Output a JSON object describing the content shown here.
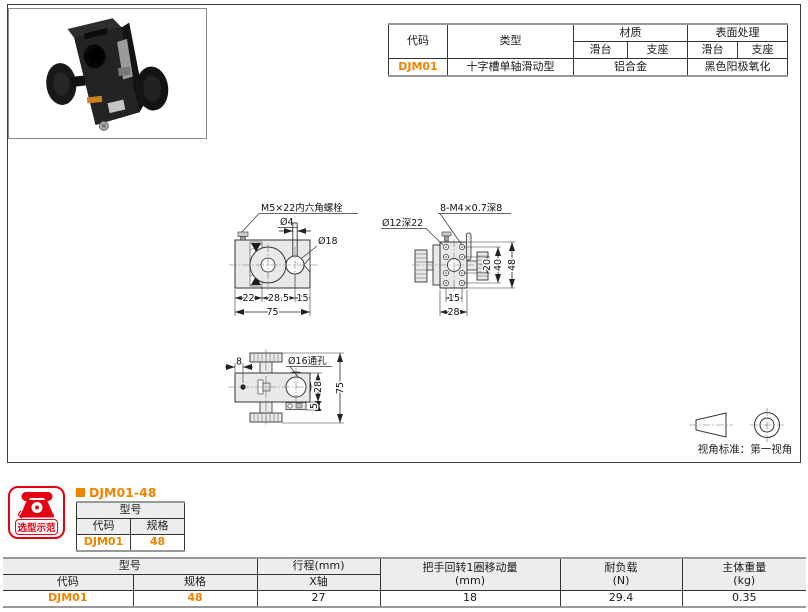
{
  "colors": {
    "accent": "#f08300",
    "badge_red": "#e60012"
  },
  "spec_table": {
    "col_code": "代码",
    "col_type": "类型",
    "col_material": "材质",
    "col_surface": "表面处理",
    "sub_slide": "滑台",
    "sub_base": "支座",
    "sub_slide2": "滑台",
    "sub_base2": "支座",
    "row": {
      "code": "DJM01",
      "type": "十字槽单轴滑动型",
      "material": "铝合金",
      "surface": "黑色阳极氧化"
    }
  },
  "drawing_front": {
    "bolt_label": "M5×22内六角螺栓",
    "dia4": "Ø4",
    "dia18": "Ø18",
    "dim_22": "22",
    "dim_28_5": "28.5",
    "dim_15": "15",
    "dim_75": "75"
  },
  "drawing_side": {
    "holes_label": "8-M4×0.7深8",
    "dia12": "Ø12深22",
    "dim_20": "20",
    "dim_40": "40",
    "dim_48": "48",
    "dim_15": "15",
    "dim_28": "28"
  },
  "drawing_top": {
    "dia16": "Ø16通孔",
    "dim_8": "8",
    "dim_28": "28",
    "dim_75": "75",
    "dim_5": "5"
  },
  "view_symbol": {
    "note": "视角标准：第一视角"
  },
  "selection": {
    "badge": "选型示范",
    "title": "DJM01-48",
    "header_model": "型号",
    "header_code": "代码",
    "header_spec": "规格",
    "code": "DJM01",
    "spec": "48"
  },
  "bottom_table": {
    "model": "型号",
    "code": "代码",
    "spec": "规格",
    "stroke": "行程(mm)",
    "x_axis": "X轴",
    "handle": "把手回转1圈移动量",
    "handle_unit": "(mm)",
    "load": "耐负载",
    "load_unit": "(N)",
    "weight": "主体重量",
    "weight_unit": "(kg)",
    "row": {
      "code": "DJM01",
      "spec": "48",
      "stroke": "27",
      "handle": "18",
      "load": "29.4",
      "weight": "0.35"
    }
  }
}
